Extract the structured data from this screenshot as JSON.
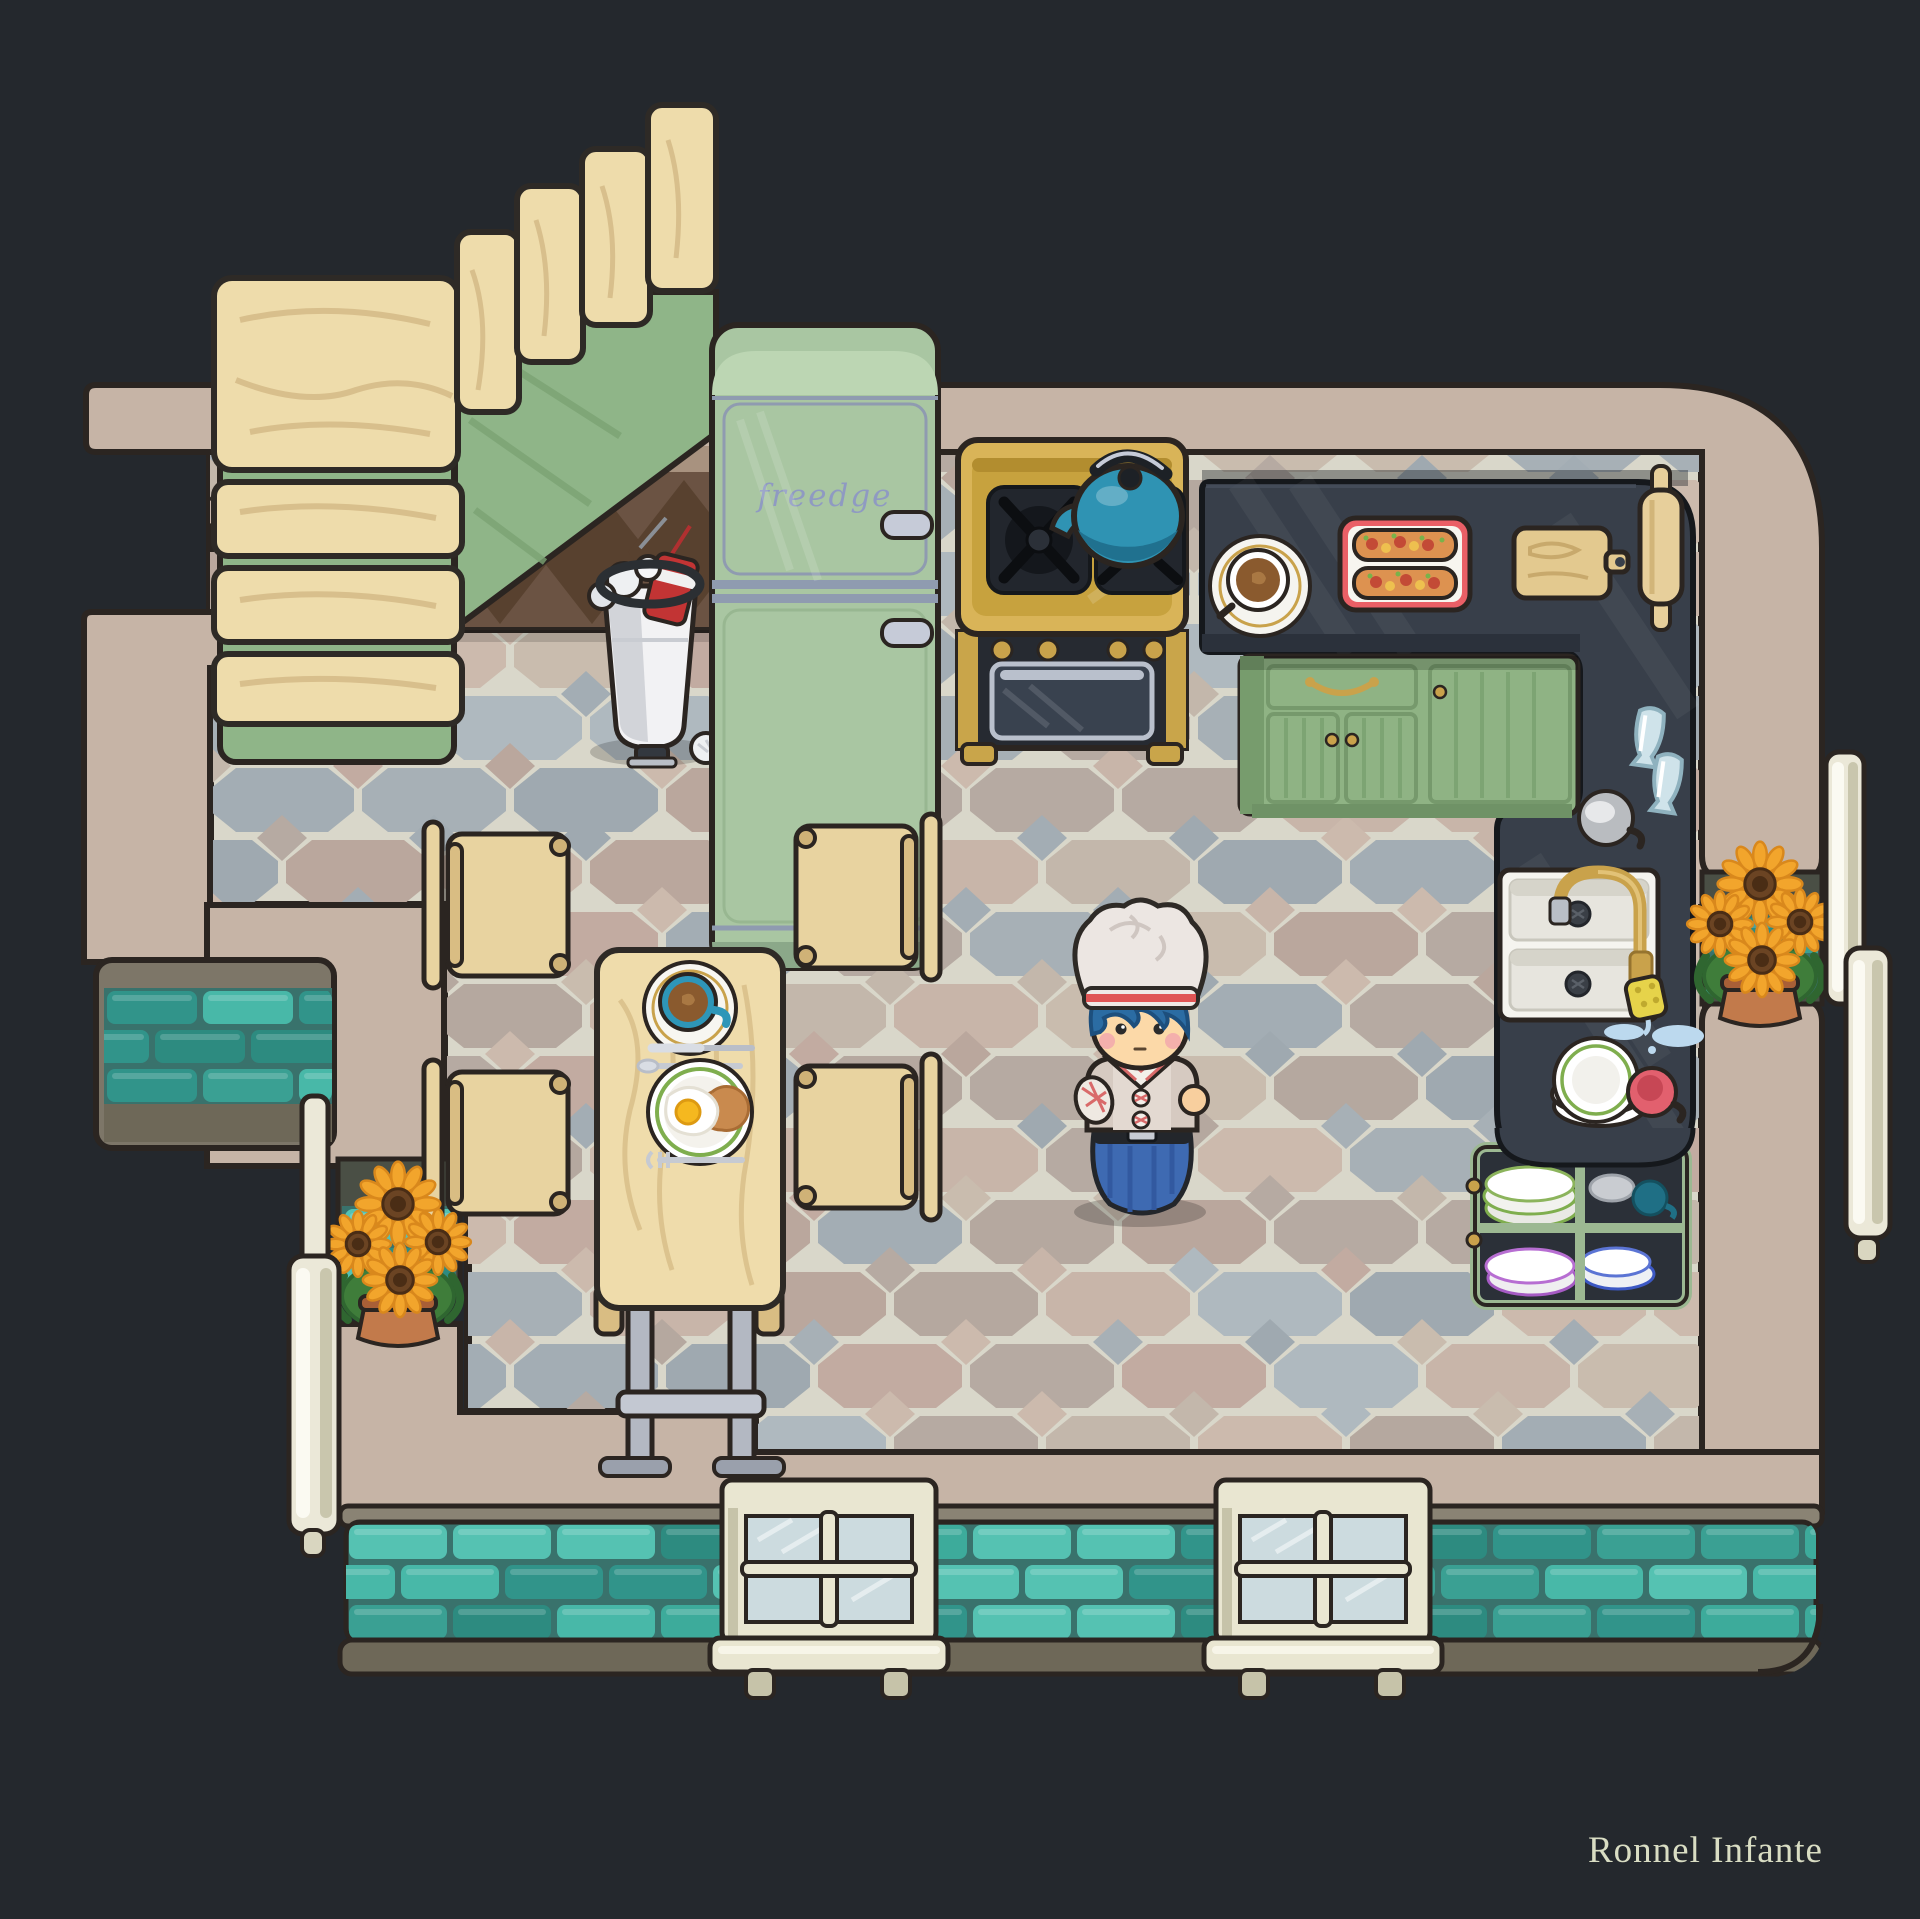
{
  "canvas": {
    "width": 1920,
    "height": 1919,
    "background": "#24282d"
  },
  "artist": {
    "credit": "Ronnel Infante"
  },
  "fridge": {
    "brand": "freedge",
    "body_color": "#a9c6a2",
    "accent": "#c6cbd8"
  },
  "scene": {
    "type": "top-down cozy kitchen game room",
    "character": {
      "name": "chef",
      "hat_band": "#e05555",
      "hair": "#2b6ca3",
      "pants": "#3e6ab2"
    },
    "counter_items": [
      "coffee-cup",
      "sandwich-tray",
      "cutting-board",
      "rolling-pin",
      "glass",
      "glass",
      "gray-cup",
      "sink",
      "sponge",
      "plate-stack",
      "pink-mug"
    ],
    "table_items": [
      "teal-coffee-cup",
      "knife",
      "spoon",
      "fried-egg-plate",
      "fork"
    ],
    "shelf_contents": [
      "green-rim-plates",
      "gray-bowl",
      "teal-mug",
      "purple-rim-plates",
      "blue-rim-plates"
    ],
    "stairs": {
      "steps": 7,
      "wood": "#eedcab",
      "stringer": "#8fb588"
    },
    "plants": [
      "sunflower-pot-left",
      "sunflower-pot-right"
    ],
    "appliances": [
      "refrigerator",
      "stove-oven",
      "kettle",
      "trash-can"
    ]
  },
  "palette": {
    "wall": "#c6b4a6",
    "outline": "#2b2521",
    "counter": "#383f4a",
    "counter_edge": "#15181c",
    "cabinet_green": "#8fb384",
    "stove_gold": "#d9b458",
    "kettle_teal": "#2f93b3",
    "door_cream": "#ebe8d8",
    "window_glass": "#ccdbdf",
    "trim_olive": "#7d7668",
    "sunflower": "#f2a52c",
    "signature": "#d9ddc3"
  },
  "floor": {
    "grout": "#d9d7ca",
    "tiles": [
      "#c2aba1",
      "#b5a89f",
      "#a7b0b6",
      "#c9bcae",
      "#baa79d",
      "#9fa9b0",
      "#c8b5a9",
      "#afb9bf",
      "#ccbaad",
      "#b6aaa2",
      "#c3b7ab",
      "#a3adb4"
    ]
  },
  "bricks": {
    "mortar": "#39726c",
    "colors": [
      "#3dab9b",
      "#48b8a8",
      "#31948a",
      "#55c2b2",
      "#3aa093",
      "#2d8b80"
    ]
  }
}
